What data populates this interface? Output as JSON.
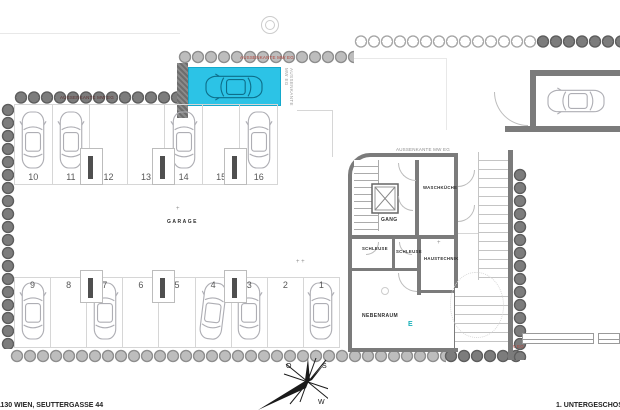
{
  "meta": {
    "address": "1130 WIEN, SEUTTERGASSE 44",
    "level": "1. UNTERGESCHOSS"
  },
  "rooms": {
    "garage": "GARAGE",
    "gang": "GANG",
    "waschkueche": "WASCHKÜCHE",
    "schleuse_a": "SCHLEUSE",
    "schleuse_b": "SCHLEUSE",
    "haustechnik": "HAUSTECHNIK",
    "nebenraum": "NEBENRAUM"
  },
  "annotations": {
    "aussenkante": "AUSSENKANTE MW EG"
  },
  "markers": {
    "e": "E",
    "plus": "+",
    "double_plus": "+ +"
  },
  "compass": {
    "o": "O",
    "s": "S",
    "w": "W"
  },
  "parking": {
    "top_row": [
      {
        "number": "10",
        "occupied": true
      },
      {
        "number": "11",
        "occupied": true
      },
      {
        "number": "12",
        "occupied": false
      },
      {
        "number": "13",
        "occupied": false
      },
      {
        "number": "14",
        "occupied": true
      },
      {
        "number": "15",
        "occupied": false
      },
      {
        "number": "16",
        "occupied": true
      }
    ],
    "bottom_row": [
      {
        "number": "9",
        "occupied": true
      },
      {
        "number": "8",
        "occupied": false
      },
      {
        "number": "7",
        "occupied": true
      },
      {
        "number": "6",
        "occupied": false
      },
      {
        "number": "5",
        "occupied": false
      },
      {
        "number": "4",
        "occupied": true,
        "angled": true
      },
      {
        "number": "3",
        "occupied": true
      },
      {
        "number": "2",
        "occupied": false
      },
      {
        "number": "1",
        "occupied": true
      }
    ],
    "highlighted_space": {
      "occupied": true
    }
  },
  "colors": {
    "highlight": "#2cc3e6",
    "wall": "#7b7b7b",
    "annotation_red": "#b24038",
    "e_marker": "#18b0b8"
  }
}
